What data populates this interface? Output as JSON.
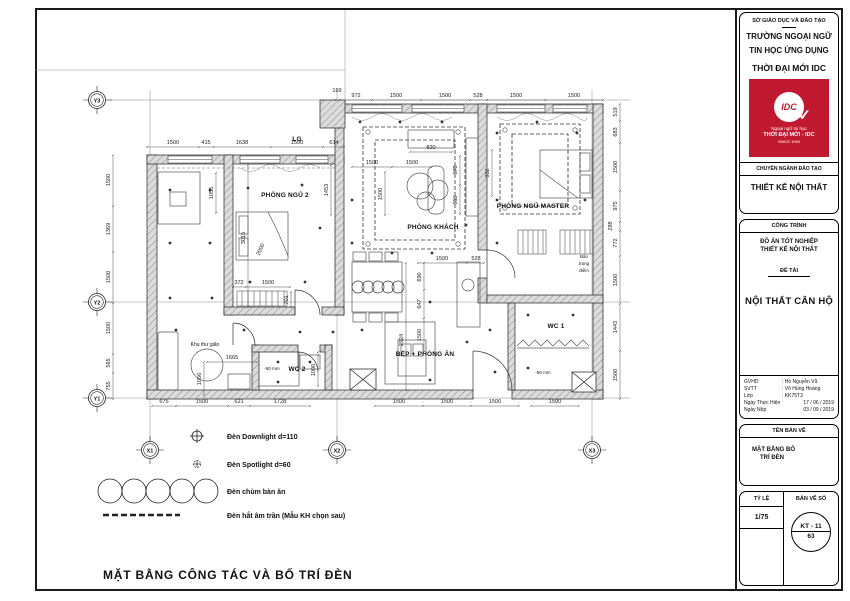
{
  "title_block": {
    "department": "SỞ GIÁO DỤC VÀ ĐÀO TẠO",
    "school_line1": "TRƯỜNG NGOẠI NGỮ",
    "school_line2": "TIN HỌC ỨNG DỤNG",
    "school_line3": "THỜI ĐẠI MỚI IDC",
    "logo": {
      "text": "IDC",
      "check": "✓",
      "sub1": "Ngoại ngữ tin học",
      "sub2": "THỜI ĐẠI MỚI - IDC",
      "sub3": "SINCE 1994",
      "color": "#c11a30"
    },
    "major_header": "CHUYÊN NGÀNH ĐÀO TẠO",
    "major": "THIẾT KẾ NỘI THẤT",
    "project_header": "CÔNG TRÌNH",
    "project_line1": "ĐỒ ÁN TỐT NGHIỆP",
    "project_line2": "THIẾT KẾ NỘI THẤT",
    "topic_header": "ĐỀ TÀI",
    "topic": "NỘI THẤT CĂN HỘ",
    "people": [
      {
        "label": "GVHD",
        "value": ": Hồ Nguyễn Vũ"
      },
      {
        "label": "SVTT",
        "value": ": Võ Hùng Hoàng"
      },
      {
        "label": "Lớp",
        "value": ": KK75T3"
      },
      {
        "label": "Ngày Thực Hiện",
        "value": "17 / 06 / 2019"
      },
      {
        "label": "Ngày Nộp",
        "value": "03 / 09 / 2019"
      }
    ],
    "drawing_name_header": "TÊN BẢN VẼ",
    "drawing_name_line1": "MẶT BẰNG BỐ",
    "drawing_name_line2": "TRÍ ĐÈN",
    "scale_header": "TỶ LỆ",
    "scale_value": "1/75",
    "sheet_header": "BẢN VẼ SỐ",
    "sheet_code": "KT - 11",
    "sheet_number": "63"
  },
  "drawing": {
    "caption": "MẶT BẰNG CÔNG TÁC VÀ BỐ TRÍ ĐÈN",
    "rooms": {
      "bedroom2": "PHÒNG NGỦ 2",
      "living": "PHÒNG KHÁCH",
      "master": "PHÒNG NGỦ MASTER",
      "kitchen": "BẾP + PHÒNG ĂN",
      "wc1": "WC 1",
      "wc2": "WC 2",
      "relax": "Khu thư giãn",
      "loggia": "LG",
      "dressing1": "Bàn",
      "dressing2": "trang",
      "dressing3": "điểm"
    },
    "notes": {
      "wc1_level": "-50 mm",
      "wc2_level": "-50 mm"
    },
    "grid": {
      "x1": "X1",
      "x2": "X2",
      "x3": "X3",
      "y1": "Y1",
      "y2": "Y2",
      "y3": "Y3"
    },
    "dims": {
      "top_a": [
        "1500",
        "415",
        "1638",
        "1500",
        "614"
      ],
      "top_b": [
        "169",
        "972",
        "1500",
        "1500",
        "528"
      ],
      "top_c": [
        "1500",
        "1500"
      ],
      "left": [
        "1500",
        "1369",
        "1500",
        "1500",
        "565",
        "755"
      ],
      "right": [
        "519",
        "683",
        "1500",
        "975",
        "288",
        "772",
        "1500",
        "1443",
        "1500"
      ],
      "bottom_a": [
        "675",
        "1500",
        "621",
        "1728"
      ],
      "bottom_b": [
        "1500",
        "1500",
        "1500"
      ],
      "bottom_c": [
        "1500"
      ],
      "interior": {
        "d820": "820",
        "liv1": "1500",
        "liv2": "1500",
        "livv": "1500",
        "s978": "978",
        "s919": "919",
        "m932": "932",
        "b1055": "1055",
        "b3015": "3015",
        "bed2000": "2000",
        "r1453": "1453",
        "h372": "372",
        "h1500": "1500",
        "h701": "701",
        "relax1665": "1665",
        "relax1056": "1056",
        "wc21000": "1000",
        "k690": "690",
        "k647": "647",
        "k1500": "1500",
        "k2924": "2924",
        "kt1500": "1500",
        "kt528": "528"
      }
    }
  },
  "legend": {
    "items": [
      {
        "symbol": "downlight-symbol",
        "label": "Đèn Downlight d=110"
      },
      {
        "symbol": "spotlight-symbol",
        "label": "Đèn Spotlight d=60"
      },
      {
        "symbol": "chandelier-symbol",
        "label": "Đèn chùm bàn ăn"
      },
      {
        "symbol": "cove-light-symbol",
        "label": "Đèn hắt âm trần (Mẫu KH chọn sau)"
      }
    ]
  }
}
